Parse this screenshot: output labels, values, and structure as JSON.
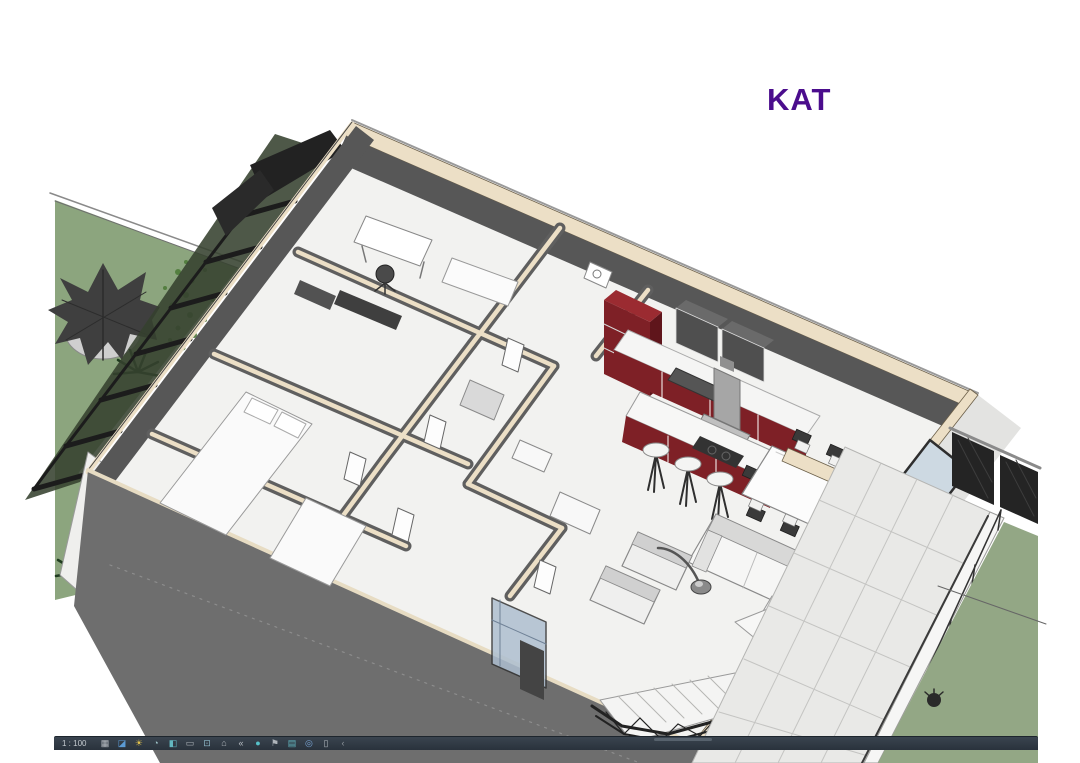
{
  "title": {
    "text": "KAT",
    "color": "#4b0d8d"
  },
  "view_control_bar": {
    "scale": "1 : 100",
    "background": "#2e3a46",
    "icons": [
      {
        "name": "detail-level",
        "glyph": "▦",
        "color": "#b9bec4"
      },
      {
        "name": "visual-style",
        "glyph": "◪",
        "color": "#5b9bd5"
      },
      {
        "name": "sun-path",
        "glyph": "☀",
        "color": "#e3c34c"
      },
      {
        "name": "shadows",
        "glyph": "◔",
        "color": "#9fc4c9"
      },
      {
        "name": "show-rendering-dialog",
        "glyph": "◧",
        "color": "#63b7c0"
      },
      {
        "name": "crop-view",
        "glyph": "▭",
        "color": "#aeb4ba"
      },
      {
        "name": "show-crop-region",
        "glyph": "⊡",
        "color": "#8fb9c9"
      },
      {
        "name": "unlocked-3d-view",
        "glyph": "⌂",
        "color": "#aeb4ba"
      },
      {
        "name": "temporary-hide-isolate",
        "glyph": "«",
        "color": "#b9bec4"
      },
      {
        "name": "reveal-hidden-elements",
        "glyph": "●",
        "color": "#56c1c9"
      },
      {
        "name": "temporary-view-properties",
        "glyph": "⚑",
        "color": "#aeb4ba"
      },
      {
        "name": "show-analytical-model",
        "glyph": "▤",
        "color": "#63b7c0"
      },
      {
        "name": "highlight-displacement-sets",
        "glyph": "◎",
        "color": "#7aa7d9"
      },
      {
        "name": "reveal-constraints",
        "glyph": "▯",
        "color": "#aeb4ba"
      },
      {
        "name": "expand",
        "glyph": "‹",
        "color": "#8e959c"
      }
    ]
  },
  "scene": {
    "description": "Isometric cutaway 3D section view of an apartment floor (Revit shaded view)",
    "palette": {
      "lawn_left": "#8ca57e",
      "lawn_right": "#93a785",
      "wall_cut_face": "#575757",
      "wall_outer_face": "#6e6e6e",
      "wall_cap_cream": "#ecdfc6",
      "floor_white": "#f2f2f0",
      "kitchen_cabinet_red": "#7e2026",
      "glass_blue": "#cdd9e2",
      "frame_dark": "#242424",
      "terrace_tile": "#e9e9e7",
      "parapet_white": "#f6f6f5"
    }
  }
}
